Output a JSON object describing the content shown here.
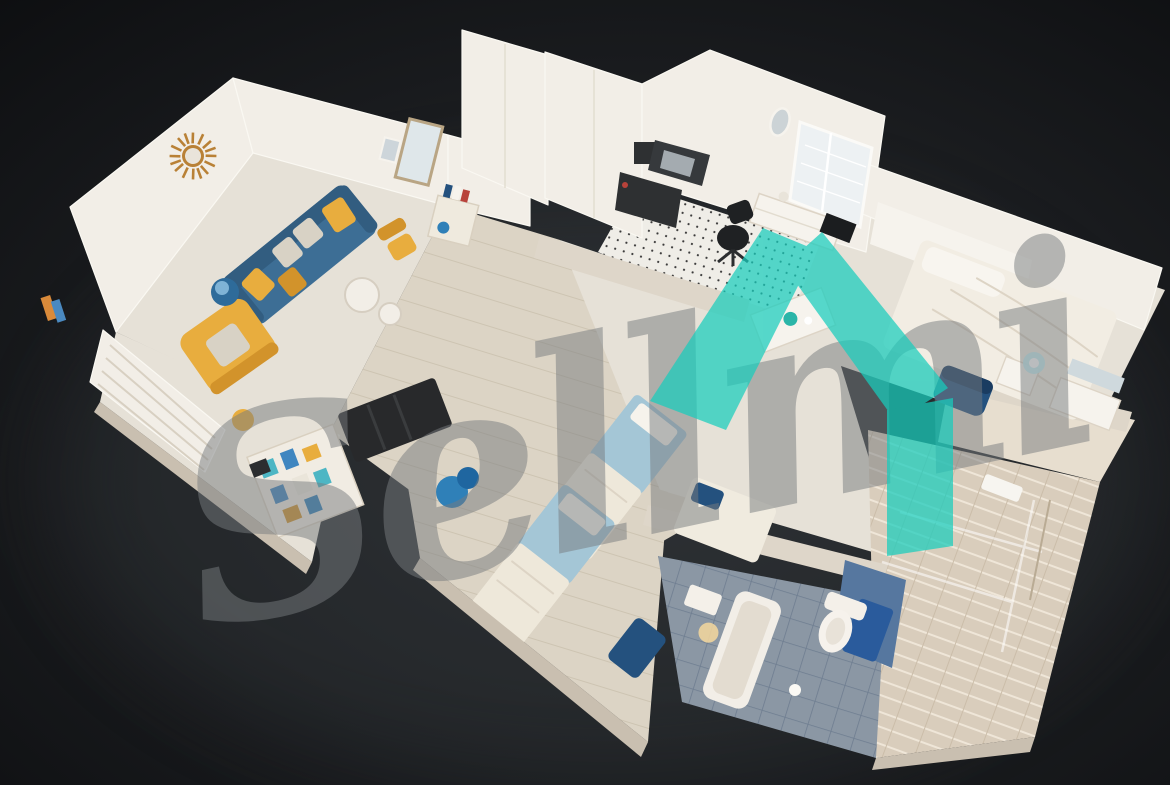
{
  "watermark": {
    "text": "Sellmi",
    "opacity": 0.5
  },
  "logo": {
    "name": "teal-house-logo",
    "opacity": 0.72
  },
  "colors": {
    "bg_corner": "#0b0c0e",
    "bg_mid": "#1b1d20",
    "bg_glow": "#2a2d31",
    "shadow": "#34383c",
    "wall": "#f2eee7",
    "wall_edge": "#faf8f2",
    "wall_shade": "#ded6c9",
    "slab": "#c9bfb0",
    "floor": "#e6e1d7",
    "floor_wood": "#dcd4c5",
    "plank": "#c8bfae",
    "kitchen_floor": "#efede7",
    "counter": "#36393c",
    "steel": "#a4abb0",
    "appliance": "#2e3032",
    "black_chair": "#1f2123",
    "sofa": "#3d6e95",
    "sofa_dark": "#325d80",
    "amber": "#e8ad3e",
    "amber_dark": "#d2932b",
    "floral": "#d8d2c5",
    "gold": "#b98136",
    "mirror_glass": "#dfe7ea",
    "window_glass": "#edf1f3",
    "bed_blue": "#a4c6d6",
    "duvet": "#eee8da",
    "white_bed": "#f2ede3",
    "navy": "#24517e",
    "navy_dark": "#1a3c61",
    "tile": "#8b97a4",
    "tile_dark": "#6e7d90",
    "navy_tile": "#2a5b9c",
    "marble": "#d9cdbc",
    "lamp_blue": "#2e6b9a",
    "bundle_blue": "#2f80b8",
    "glow": "#c2f0f4",
    "teal": "#18cdbd",
    "watermark": "#787c7f"
  },
  "scene": {
    "type": "apartment-dollhouse-3d-cutaway",
    "rooms": [
      {
        "name": "living-room",
        "furniture": [
          "sunburst-mirror",
          "blue-sofa",
          "amber-pillows",
          "yellow-armchair",
          "blue-lamp-stool",
          "round-coffee-tables"
        ]
      },
      {
        "name": "entry-hall",
        "furniture": [
          "tall-mirror",
          "bookshelf-cabinet",
          "yellow-chair",
          "blue-bottle"
        ]
      },
      {
        "name": "kitchen",
        "furniture": [
          "white-cabinets",
          "microwave",
          "steel-sink",
          "washing-machine",
          "black-office-chair",
          "shuttered-window",
          "oval-mirror",
          "sideboard"
        ]
      },
      {
        "name": "bedroom-right",
        "furniture": [
          "white-double-bed",
          "headboard-panel",
          "nightstand",
          "glowing-lamp",
          "navy-chair",
          "wall-tv"
        ]
      },
      {
        "name": "hallway",
        "furniture": [
          "dark-open-wardrobe",
          "blue-bundle",
          "kettle-table"
        ]
      },
      {
        "name": "bedroom-bottom",
        "furniture": [
          "blue-single-bed",
          "blue-single-bed",
          "navy-throw"
        ]
      },
      {
        "name": "bathroom-bottom",
        "furniture": [
          "bathtub",
          "toilet",
          "navy-tile-wall",
          "vanity-warm-light"
        ]
      },
      {
        "name": "bathroom-right",
        "furniture": [
          "marble-tiles",
          "glass-shower",
          "towel-rail",
          "white-vanity"
        ]
      },
      {
        "name": "storage-nook",
        "furniture": [
          "louver-wardrobe",
          "open-shelf-colorful",
          "amber-stool"
        ]
      }
    ]
  }
}
